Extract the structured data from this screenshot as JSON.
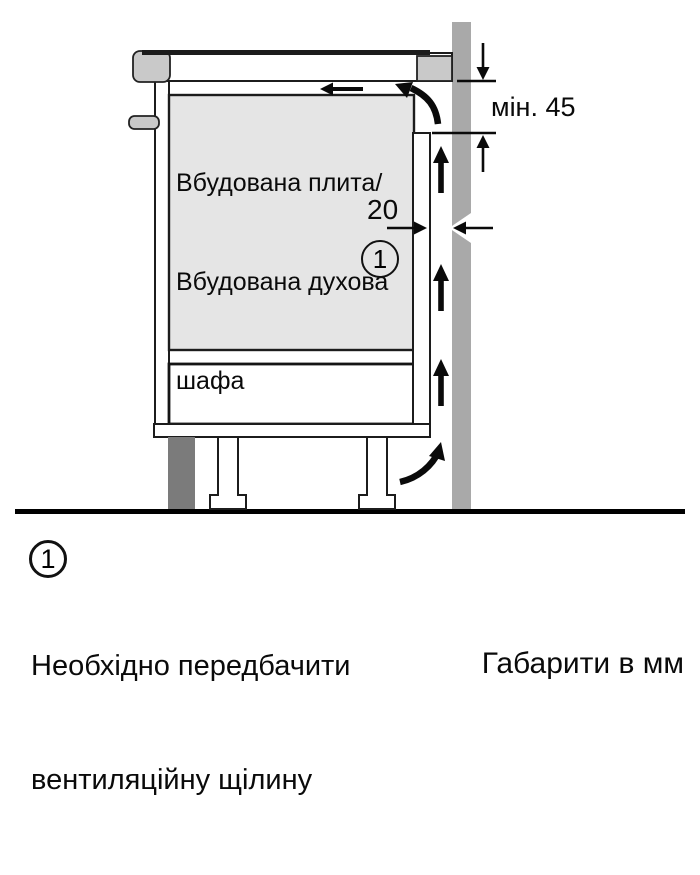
{
  "colors": {
    "background": "#ffffff",
    "wall": "#a9a9a9",
    "plinth": "#7b7b7b",
    "counter_block": "#c9c9c9",
    "cabinet_fill": "#e5e5e5",
    "line": "#0a0a0a"
  },
  "diagram": {
    "cabinet_label": {
      "lines": [
        "Вбудована плита/",
        "Вбудована духова",
        "шафа"
      ]
    },
    "dimensions": {
      "min_top_gap": "мін. 45",
      "vent_gap_width": "20"
    },
    "callout_marker": "1"
  },
  "legend": {
    "marker": "1",
    "note_lines": [
      "Необхідно передбачити",
      "вентиляційну щілину"
    ]
  },
  "footer": {
    "units_note": "Габарити в мм"
  }
}
